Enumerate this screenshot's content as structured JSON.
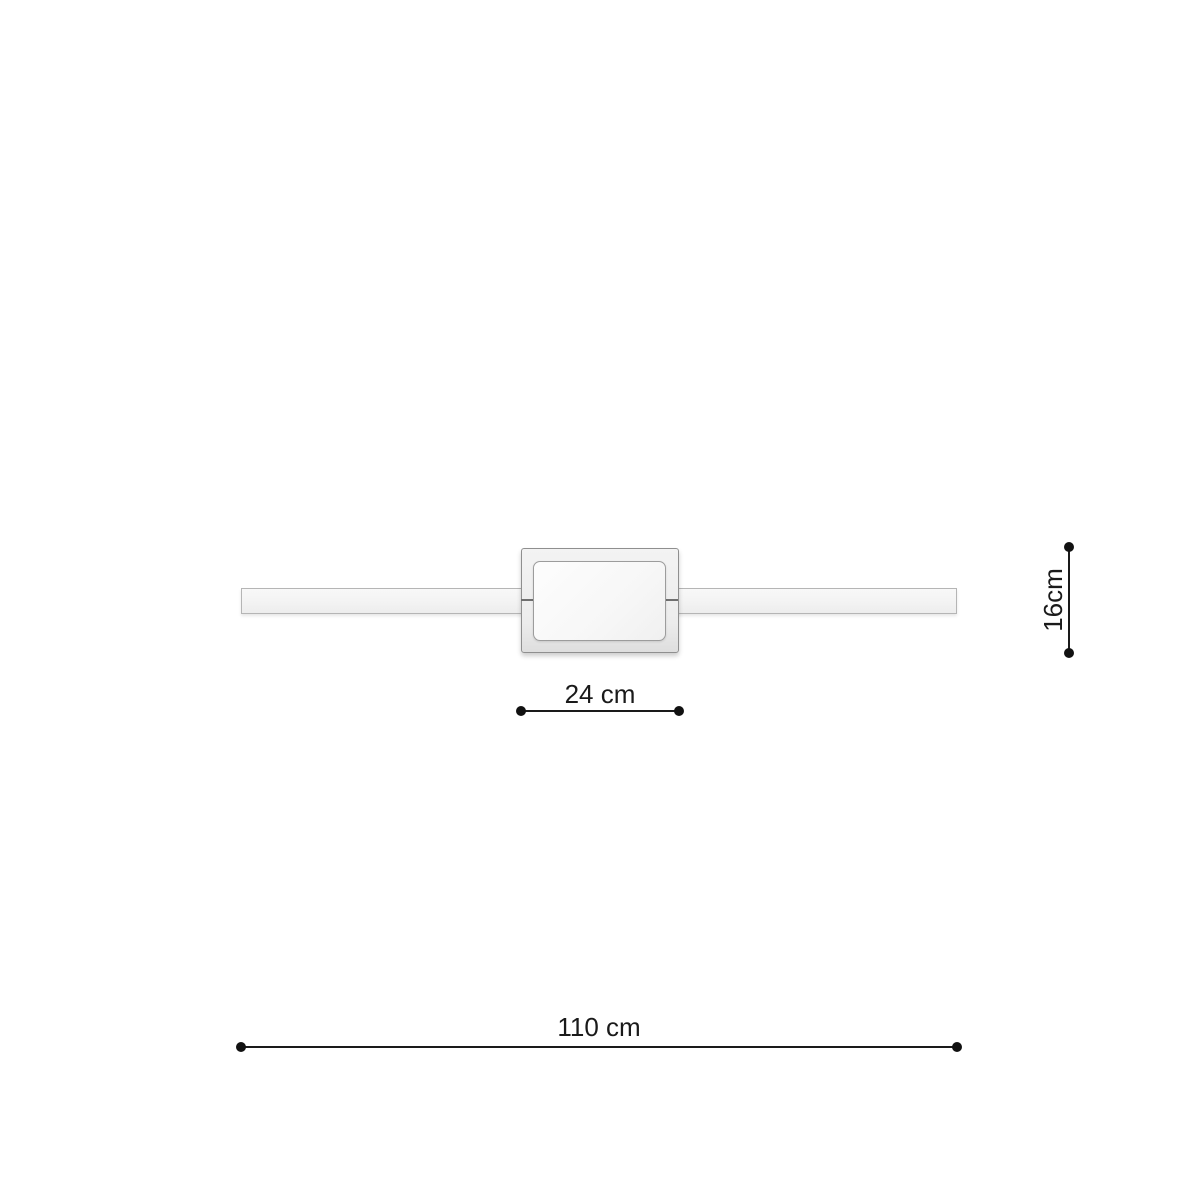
{
  "diagram": {
    "kind": "product-dimension-diagram",
    "background": "#ffffff",
    "dimensions": {
      "plate_width": {
        "label": "24 cm",
        "value_cm": 24,
        "orientation": "horizontal"
      },
      "plate_height": {
        "label": "16cm",
        "value_cm": 16,
        "orientation": "vertical"
      },
      "total_width": {
        "label": "110 cm",
        "value_cm": 110,
        "orientation": "horizontal"
      }
    },
    "colors": {
      "dimension_line": "#1a1a1a",
      "dimension_text": "#1a1a1a",
      "bar_fill": "#f4f4f4",
      "bar_border": "#b5b5b5",
      "plate_fill": "#ededed",
      "plate_border": "#8f8f8f",
      "panel_fill": "#fafafa",
      "panel_border": "#9c9c9c",
      "seam": "#6f6f6f"
    }
  }
}
